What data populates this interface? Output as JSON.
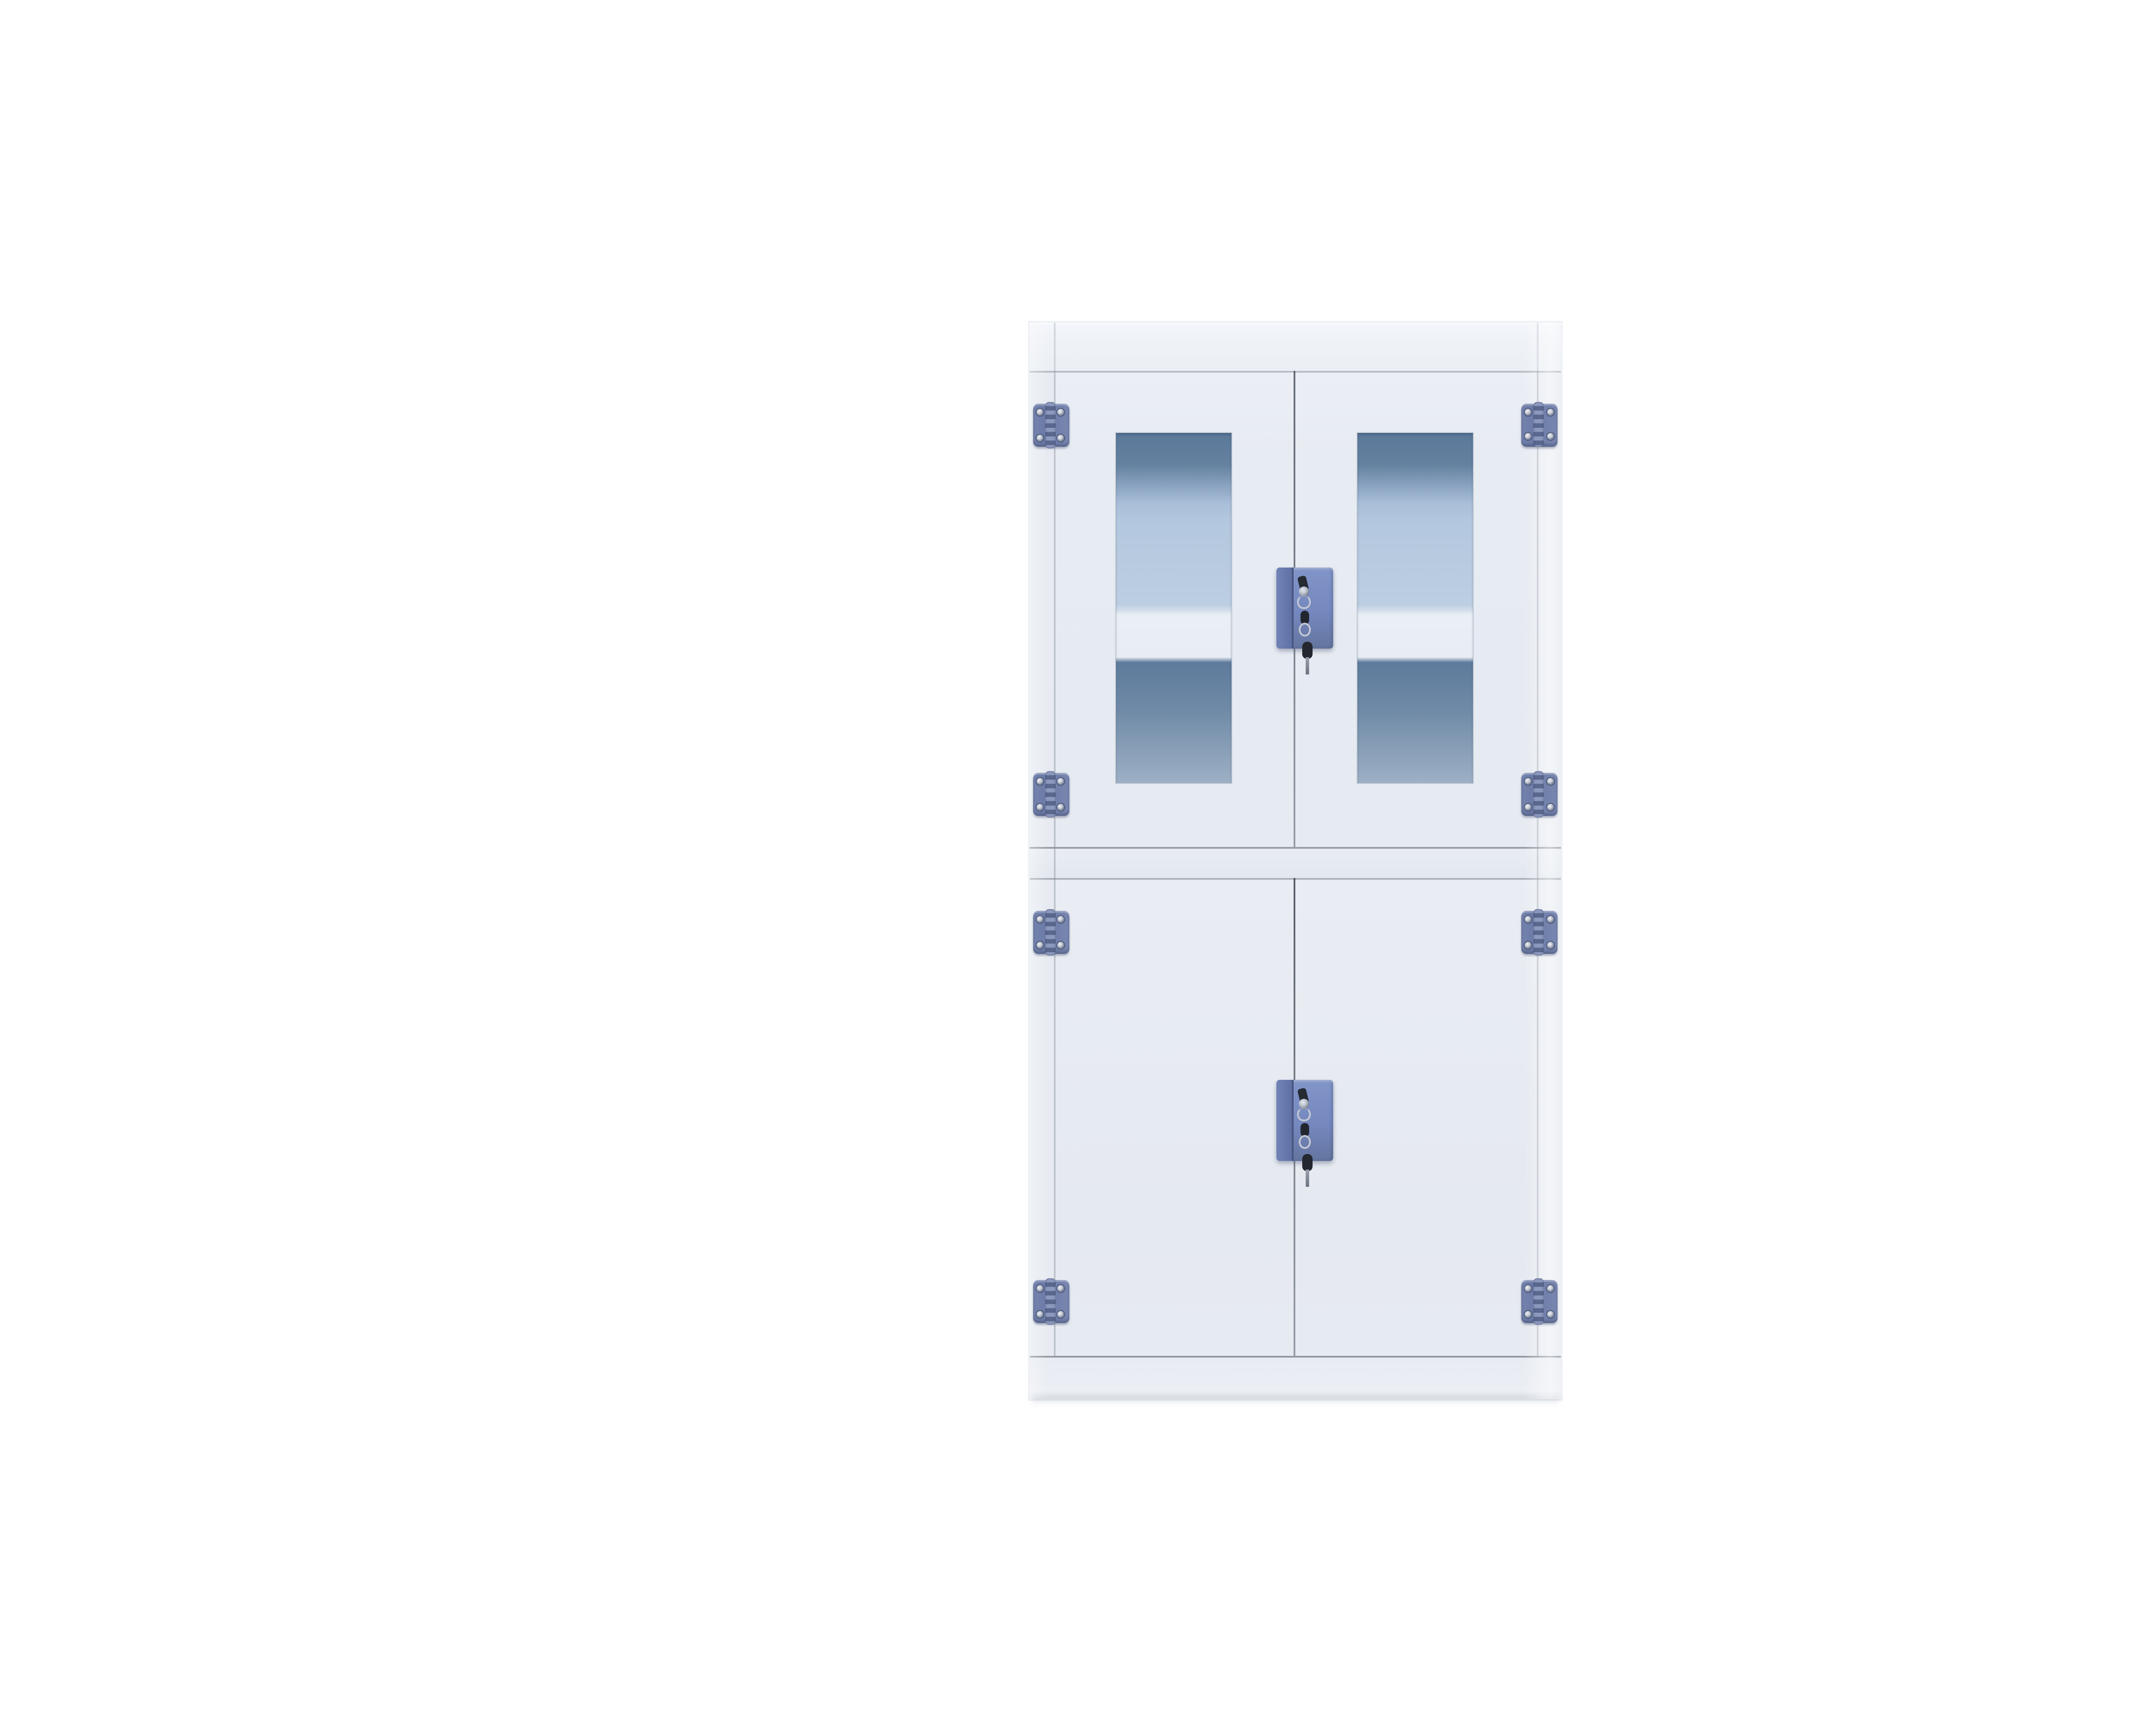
{
  "scene": {
    "background_color": "#ffffff"
  },
  "cabinet": {
    "body_color": "#e8ecf2",
    "glass_top_tint": "#5b789a",
    "glass_light_tint": "#b9cce0",
    "glass_shelf_band": "#eaeff5",
    "glass_lower_tint": "#6f8aa6",
    "hinge_color": "#6f7ea9",
    "lock_color": "#7488bf",
    "key_color": "#262a33",
    "hinge_count": 8,
    "lock_count": 2
  },
  "watermark": {
    "brand_cn": "来宝商城",
    "url": "www.lab360.cn",
    "monogram_b": "B",
    "panel_bg": "#ffffff",
    "frame_color": "#000000",
    "brand_blue": "#1464b4",
    "diamond_blue": "#1360ae",
    "tube_red": "#e51e2e"
  }
}
